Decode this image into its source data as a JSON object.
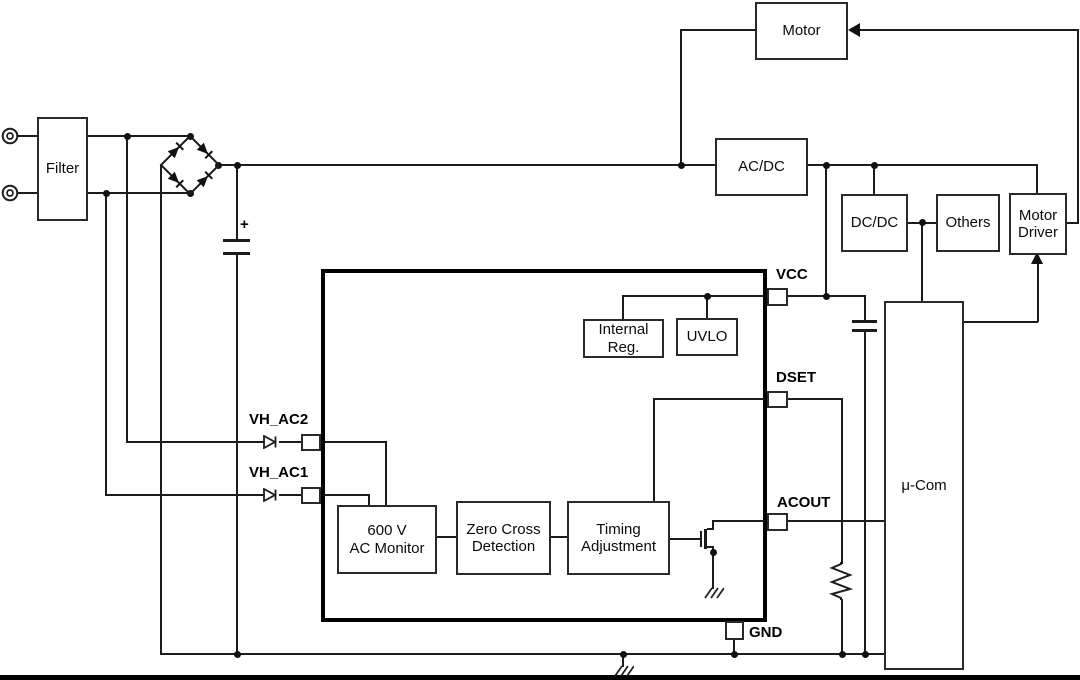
{
  "blocks": {
    "filter": "Filter",
    "motor": "Motor",
    "acdc": "AC/DC",
    "dcdc": "DC/DC",
    "others": "Others",
    "motor_driver": {
      "line1": "Motor",
      "line2": "Driver"
    },
    "ucom": "μ-Com",
    "internal_reg": {
      "line1": "Internal",
      "line2": "Reg."
    },
    "uvlo": "UVLO",
    "ac_monitor": {
      "line1": "600 V",
      "line2": "AC Monitor"
    },
    "zero_cross": {
      "line1": "Zero Cross",
      "line2": "Detection"
    },
    "timing": {
      "line1": "Timing",
      "line2": "Adjustment"
    }
  },
  "pins": {
    "vh_ac2": "VH_AC2",
    "vh_ac1": "VH_AC1",
    "vcc": "VCC",
    "dset": "DSET",
    "acout": "ACOUT",
    "gnd": "GND"
  },
  "symbols": {
    "capacitor_polarity": "+"
  },
  "colors": {
    "wire": "#1c1c1c",
    "text": "#000000",
    "background": "#ffffff"
  }
}
